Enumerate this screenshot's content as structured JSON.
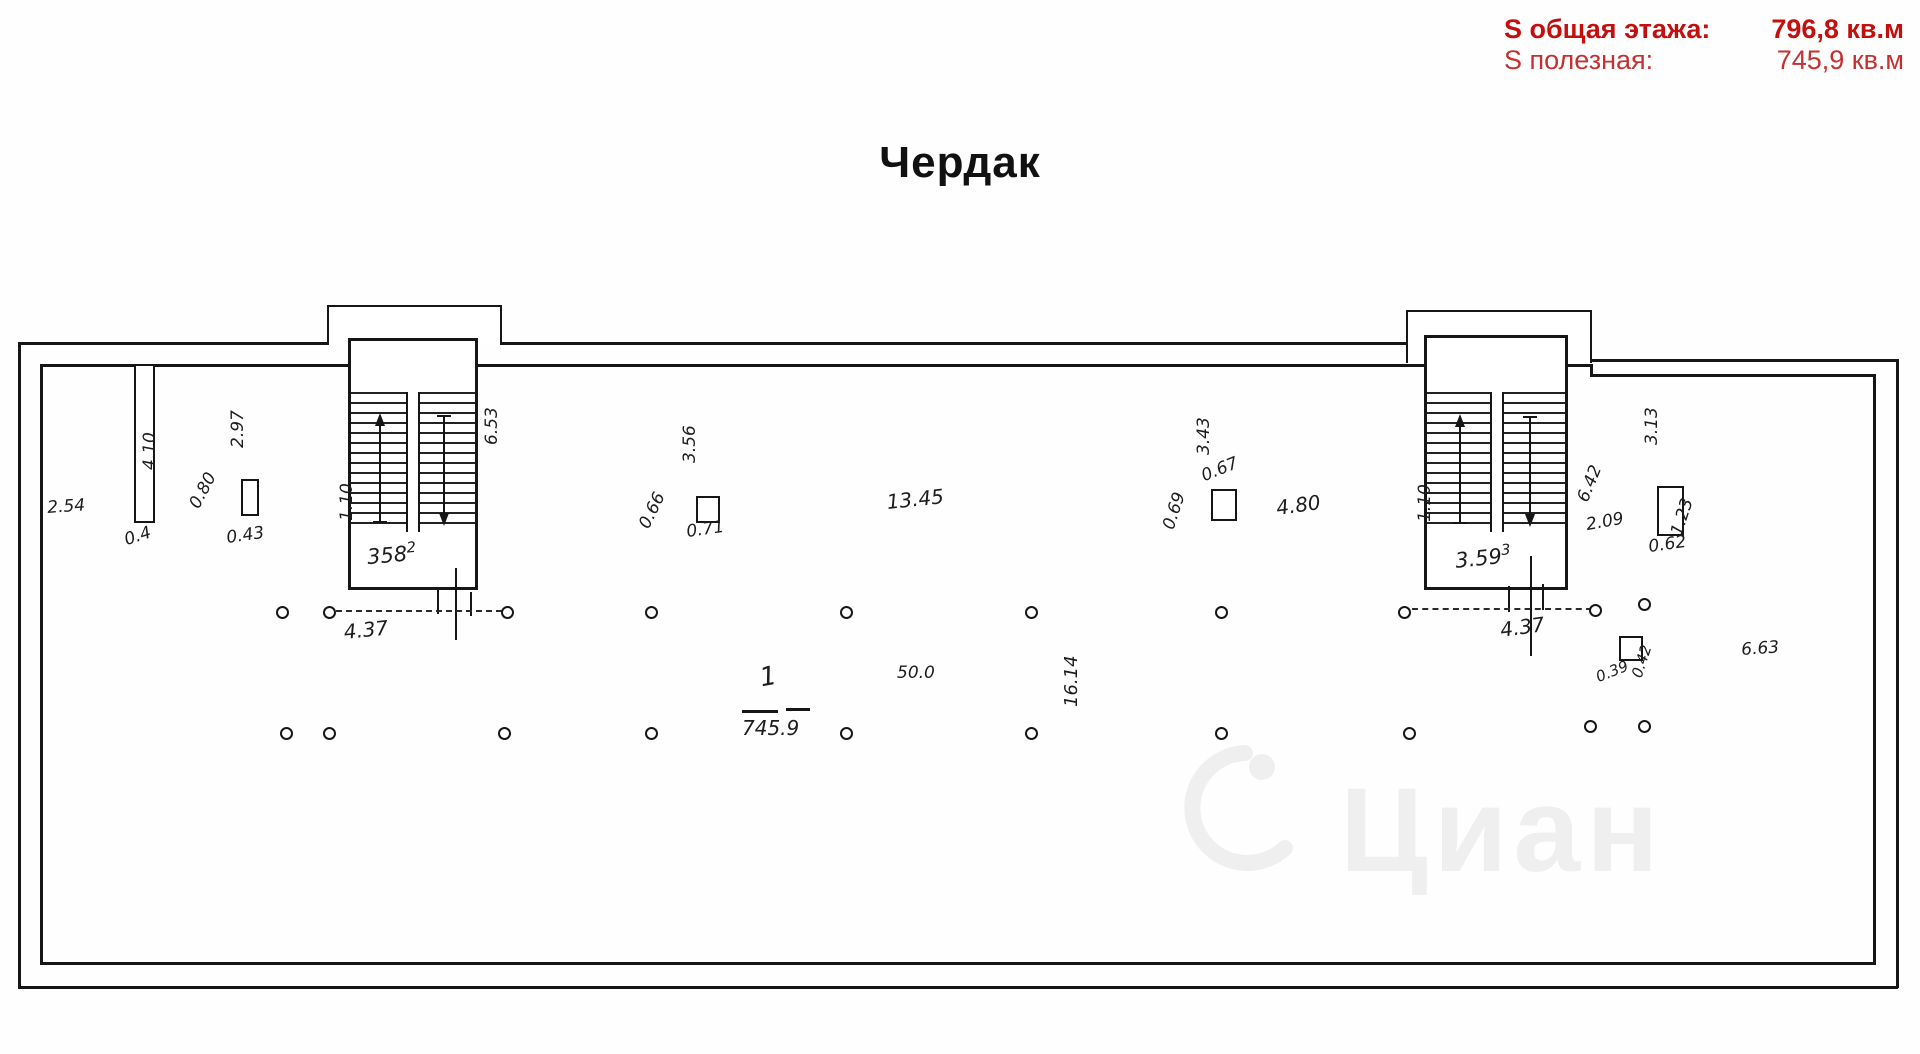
{
  "header": {
    "line1_label": "S общая этажа:",
    "line1_value": "796,8 кв.м",
    "line2_label": "S полезная:",
    "line2_value": "745,9 кв.м",
    "accent_color": "#c40f0f"
  },
  "title": "Чердак",
  "watermark": {
    "text": "Циан"
  },
  "plan": {
    "hall": {
      "number": "1",
      "area": "745.9"
    },
    "stairwells": {
      "left": {
        "flow_label": "1.10",
        "room_area": "358",
        "room_sup": "2",
        "width_dim": "4.37"
      },
      "right": {
        "flow_label": "1.10",
        "room_area": "3.59",
        "room_sup": "3",
        "width_dim": "4.37"
      }
    },
    "annotations": [
      {
        "id": "dim-2-54",
        "text": "2.54"
      },
      {
        "id": "dim-4-10",
        "text": "4.10"
      },
      {
        "id": "dim-0-4",
        "text": "0.4"
      },
      {
        "id": "dim-0-80",
        "text": "0.80"
      },
      {
        "id": "dim-0-43",
        "text": "0.43"
      },
      {
        "id": "dim-2-97",
        "text": "2.97"
      },
      {
        "id": "dim-6-53",
        "text": "6.53"
      },
      {
        "id": "dim-3-56",
        "text": "3.56"
      },
      {
        "id": "dim-0-66",
        "text": "0.66"
      },
      {
        "id": "dim-0-71",
        "text": "0.71"
      },
      {
        "id": "dim-13-45",
        "text": "13.45"
      },
      {
        "id": "dim-3-43",
        "text": "3.43"
      },
      {
        "id": "dim-0-67",
        "text": "0.67"
      },
      {
        "id": "dim-0-69",
        "text": "0.69"
      },
      {
        "id": "dim-4-80",
        "text": "4.80"
      },
      {
        "id": "dim-3-13",
        "text": "3.13"
      },
      {
        "id": "dim-6-42",
        "text": "6.42"
      },
      {
        "id": "dim-2-09",
        "text": "2.09"
      },
      {
        "id": "dim-1-23",
        "text": "1.23"
      },
      {
        "id": "dim-0-62",
        "text": "0.62"
      },
      {
        "id": "dim-50-0",
        "text": "50.0"
      },
      {
        "id": "dim-16-14",
        "text": "16.14"
      },
      {
        "id": "dim-0-39",
        "text": "0.39"
      },
      {
        "id": "dim-0-42",
        "text": "0.42"
      },
      {
        "id": "dim-6-63",
        "text": "6.63"
      }
    ]
  }
}
